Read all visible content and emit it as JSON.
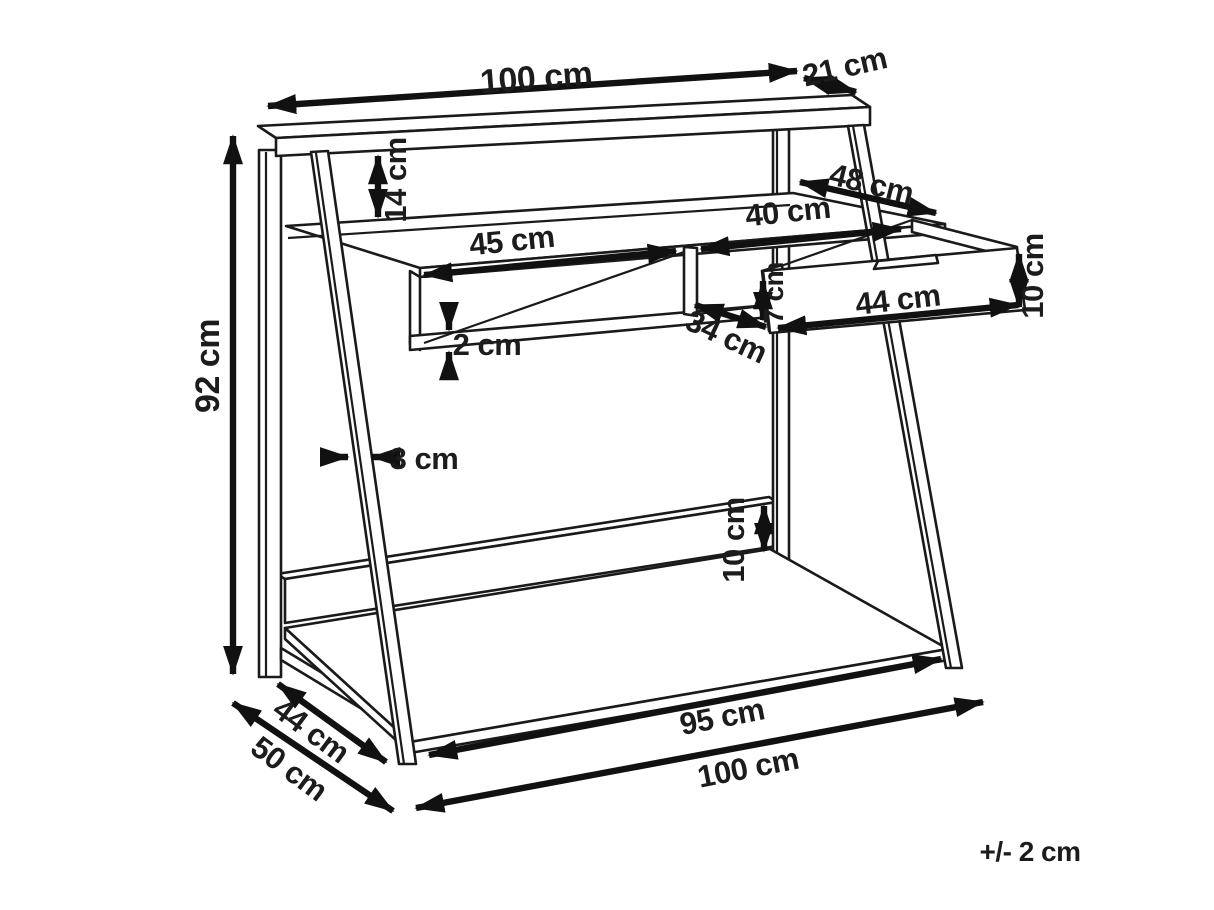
{
  "diagram": {
    "kind": "furniture-dimension-drawing",
    "subject": "ladder desk with riser shelf, open cubby, drawer and bottom shelf",
    "unit": "cm",
    "labels": {
      "top_width": "100 cm",
      "riser_depth": "21 cm",
      "riser_height": "14 cm",
      "desktop_depth": "48 cm",
      "drawer_bay_width": "40 cm",
      "cubby_width": "45 cm",
      "drawer_height": "10 cm",
      "drawer_front_width": "44 cm",
      "drawer_side_height": "7 cm",
      "drawer_bay_depth": "34 cm",
      "panel_thickness": "2 cm",
      "overall_height": "92 cm",
      "frame_thickness": "3 cm",
      "back_rail_height": "10 cm",
      "bottom_shelf_depth": "44 cm",
      "overall_depth": "50 cm",
      "bottom_shelf_width": "95 cm",
      "overall_width": "100 cm",
      "tolerance": "+/- 2 cm"
    }
  }
}
